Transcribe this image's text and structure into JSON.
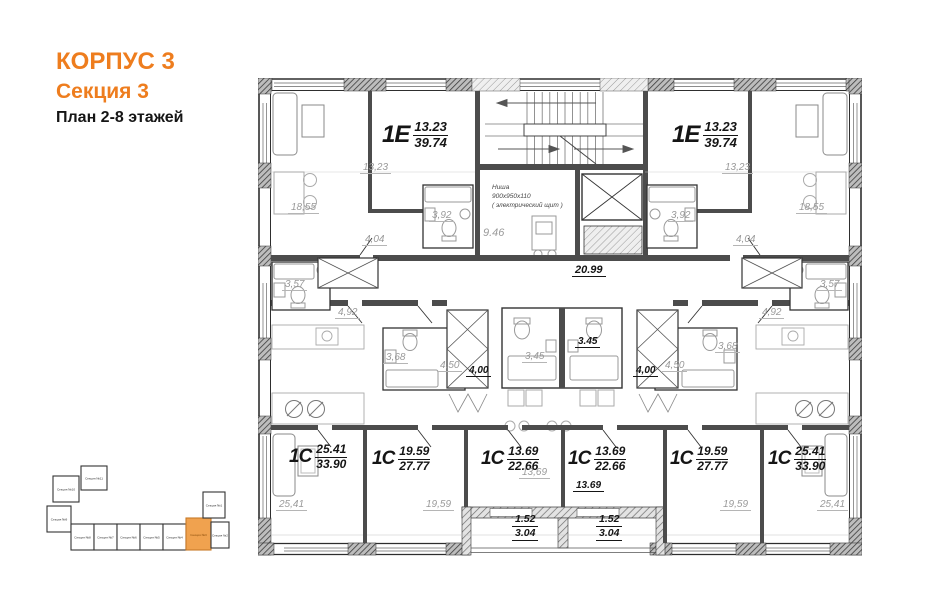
{
  "header": {
    "building": "КОРПУС 3",
    "section": "Секция 3",
    "plan": "План 2-8 этажей"
  },
  "plan": {
    "apartments": {
      "top_left": {
        "type": "1Е",
        "living": "13.23",
        "total": "39.74"
      },
      "top_right": {
        "type": "1Е",
        "living": "13.23",
        "total": "39.74"
      },
      "bottom": [
        {
          "type": "1С",
          "living": "25.41",
          "total": "33.90"
        },
        {
          "type": "1С",
          "living": "19.59",
          "total": "27.77"
        },
        {
          "type": "1С",
          "living": "13.69",
          "total": "22.66"
        },
        {
          "type": "1С",
          "living": "13.69",
          "total": "22.66"
        },
        {
          "type": "1С",
          "living": "19.59",
          "total": "27.77"
        },
        {
          "type": "1С",
          "living": "25.41",
          "total": "33.90"
        }
      ]
    },
    "labels": {
      "tl_room": "18,55",
      "tl_bedroom": "13,23",
      "tl_bath": "3,92",
      "tl_hall": "4,04",
      "tr_room": "18,55",
      "tr_bedroom": "13,23",
      "tr_bath": "3,92",
      "tr_hall": "4,04",
      "lobby": "9.46",
      "corridor": "20.99",
      "left_bath": "3,57",
      "left_hall": "4,92",
      "left_wc": "3,68",
      "left_dim_a": "4,50",
      "left_dim_b": "4,00",
      "center_bath_left": "3,45",
      "center_bath_right": "3.45",
      "right_dim_b": "4,00",
      "right_dim_a": "4,50",
      "right_wc": "3,68",
      "right_hall": "4,92",
      "right_bath": "3,57",
      "room_1": "25,41",
      "room_2": "19,59",
      "room_3": "13,69",
      "room_4": "13.69",
      "room_5": "19,59",
      "room_6": "25,41"
    },
    "balcony_left": {
      "top": "1.52",
      "bottom": "3.04"
    },
    "balcony_right": {
      "top": "1.52",
      "bottom": "3.04"
    },
    "niche": {
      "line1": "Ниша",
      "line2": "900х950х110",
      "line3": "( электрический щит )"
    }
  },
  "minimap": {
    "highlight_color": "#F0A24F",
    "sections": [
      {
        "label": "Секция №10"
      },
      {
        "label": "Секция №11"
      },
      {
        "label": "Секция №9"
      },
      {
        "label": "Секция №8"
      },
      {
        "label": "Секция №7"
      },
      {
        "label": "Секция №6"
      },
      {
        "label": "Секция №5"
      },
      {
        "label": "Секция №4"
      },
      {
        "label": "Секция №3",
        "highlighted": true
      },
      {
        "label": "Секция №2"
      },
      {
        "label": "Секция №1"
      }
    ]
  }
}
